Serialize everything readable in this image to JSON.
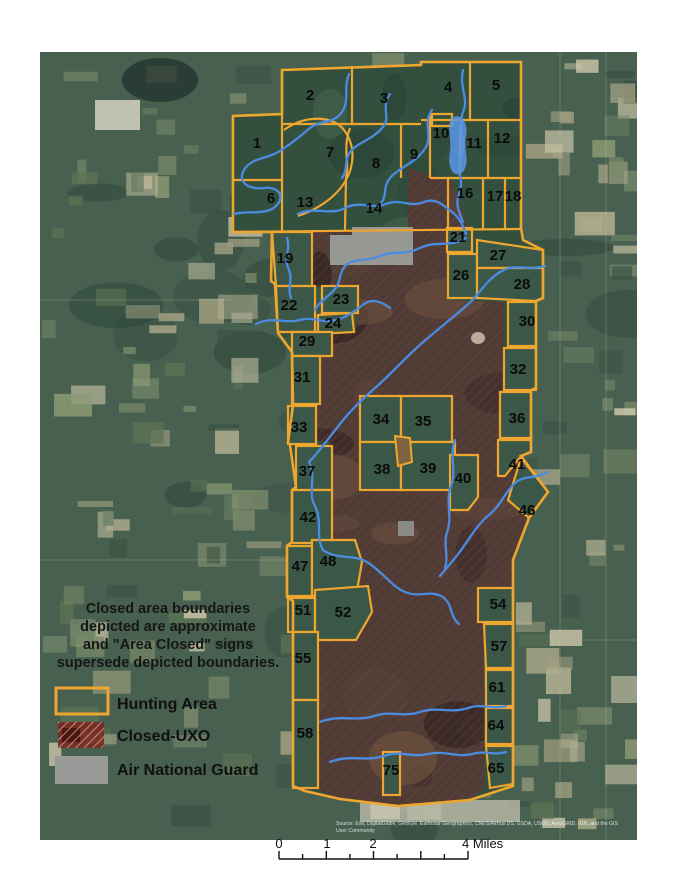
{
  "map": {
    "zones": [
      {
        "n": "1",
        "x": 257,
        "y": 143
      },
      {
        "n": "2",
        "x": 310,
        "y": 95
      },
      {
        "n": "3",
        "x": 384,
        "y": 98
      },
      {
        "n": "4",
        "x": 448,
        "y": 87
      },
      {
        "n": "5",
        "x": 496,
        "y": 85
      },
      {
        "n": "6",
        "x": 271,
        "y": 198
      },
      {
        "n": "7",
        "x": 330,
        "y": 152
      },
      {
        "n": "8",
        "x": 376,
        "y": 163
      },
      {
        "n": "9",
        "x": 414,
        "y": 154
      },
      {
        "n": "10",
        "x": 441,
        "y": 133
      },
      {
        "n": "11",
        "x": 474,
        "y": 143
      },
      {
        "n": "12",
        "x": 502,
        "y": 138
      },
      {
        "n": "13",
        "x": 305,
        "y": 202
      },
      {
        "n": "14",
        "x": 374,
        "y": 208
      },
      {
        "n": "16",
        "x": 465,
        "y": 193
      },
      {
        "n": "17",
        "x": 495,
        "y": 196
      },
      {
        "n": "18",
        "x": 513,
        "y": 196
      },
      {
        "n": "19",
        "x": 285,
        "y": 258
      },
      {
        "n": "21",
        "x": 458,
        "y": 237
      },
      {
        "n": "22",
        "x": 289,
        "y": 305
      },
      {
        "n": "23",
        "x": 341,
        "y": 299
      },
      {
        "n": "24",
        "x": 333,
        "y": 323
      },
      {
        "n": "26",
        "x": 461,
        "y": 275
      },
      {
        "n": "27",
        "x": 498,
        "y": 255
      },
      {
        "n": "28",
        "x": 522,
        "y": 284
      },
      {
        "n": "29",
        "x": 307,
        "y": 341
      },
      {
        "n": "30",
        "x": 527,
        "y": 321
      },
      {
        "n": "31",
        "x": 302,
        "y": 377
      },
      {
        "n": "32",
        "x": 518,
        "y": 369
      },
      {
        "n": "33",
        "x": 299,
        "y": 427
      },
      {
        "n": "34",
        "x": 381,
        "y": 419
      },
      {
        "n": "35",
        "x": 423,
        "y": 421
      },
      {
        "n": "36",
        "x": 517,
        "y": 418
      },
      {
        "n": "37",
        "x": 307,
        "y": 471
      },
      {
        "n": "38",
        "x": 382,
        "y": 469
      },
      {
        "n": "39",
        "x": 428,
        "y": 468
      },
      {
        "n": "40",
        "x": 463,
        "y": 478
      },
      {
        "n": "41",
        "x": 517,
        "y": 464
      },
      {
        "n": "42",
        "x": 308,
        "y": 517
      },
      {
        "n": "46",
        "x": 527,
        "y": 510
      },
      {
        "n": "47",
        "x": 300,
        "y": 566
      },
      {
        "n": "48",
        "x": 328,
        "y": 561
      },
      {
        "n": "51",
        "x": 303,
        "y": 610
      },
      {
        "n": "52",
        "x": 343,
        "y": 612
      },
      {
        "n": "54",
        "x": 498,
        "y": 604
      },
      {
        "n": "55",
        "x": 303,
        "y": 658
      },
      {
        "n": "57",
        "x": 499,
        "y": 646
      },
      {
        "n": "58",
        "x": 305,
        "y": 733
      },
      {
        "n": "61",
        "x": 497,
        "y": 687
      },
      {
        "n": "64",
        "x": 496,
        "y": 725
      },
      {
        "n": "65",
        "x": 496,
        "y": 768
      },
      {
        "n": "75",
        "x": 391,
        "y": 770
      }
    ],
    "attribution": [
      "Source: Esri, DigitalGlobe, GeoEye, Earthstar Geographics, CNES/Airbus DS, USDA, USGS, AeroGRID, IGN, and the GIS",
      "User Community"
    ]
  },
  "disclaimer": {
    "lines": [
      "Closed area boundaries",
      "depicted are approximate",
      "and \"Area Closed\" signs",
      "supersede depicted boundaries."
    ]
  },
  "legend": {
    "items": [
      {
        "label": "Hunting Area",
        "swatch": "hunting-area"
      },
      {
        "label": "Closed-UXO",
        "swatch": "closed-uxo"
      },
      {
        "label": "Air National Guard",
        "swatch": "air-national-guard"
      }
    ]
  },
  "scalebar": {
    "labels": [
      {
        "text": "0",
        "x": 279,
        "anchor": "middle"
      },
      {
        "text": "1",
        "x": 327,
        "anchor": "middle"
      },
      {
        "text": "2",
        "x": 373,
        "anchor": "middle"
      },
      {
        "text": "4 Miles",
        "x": 462,
        "anchor": "start"
      }
    ],
    "start_x": 279,
    "end_x": 468,
    "segments": 8
  },
  "colors": {
    "boundary_orange": "#EFA62F",
    "stream_blue": "#4b8be0",
    "uxo_hatch_red": "#a03c30",
    "ang_gray": "#999b98"
  }
}
